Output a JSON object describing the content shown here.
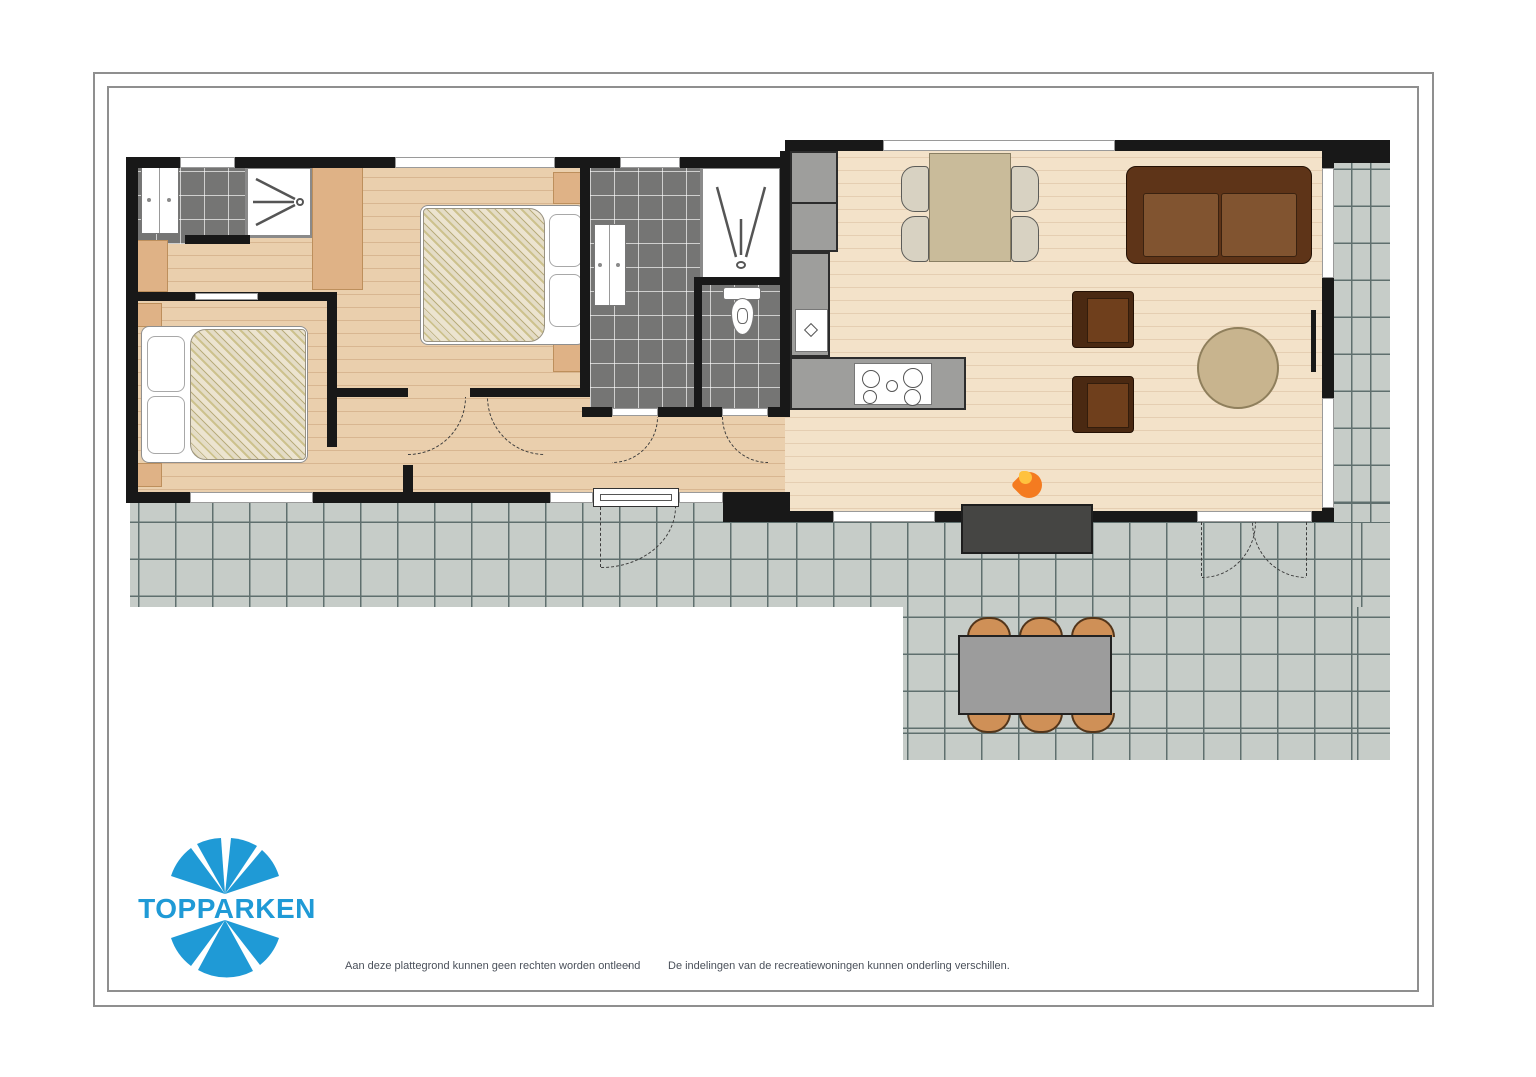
{
  "document": {
    "type": "floor-plan",
    "brand": "TOPPARKEN"
  },
  "logo": {
    "text": "TOPPARKEN",
    "color": "#1f9ad6"
  },
  "footer": {
    "left": "Aan deze plattegrond kunnen geen rechten worden ontleend",
    "separator": "-",
    "right": "De indelingen van de recreatiewoningen kunnen onderling verschillen."
  },
  "icons": {
    "flame": "🔥",
    "shower_spray": "spray-lines",
    "sink_diamond": "◇"
  },
  "rooms": [
    {
      "name": "bedroom-1"
    },
    {
      "name": "bedroom-2"
    },
    {
      "name": "small-bathroom"
    },
    {
      "name": "bathroom"
    },
    {
      "name": "toilet"
    },
    {
      "name": "hallway"
    },
    {
      "name": "living-room-kitchen"
    },
    {
      "name": "terrace"
    }
  ],
  "furniture": [
    "double-bed-1",
    "double-bed-2",
    "wardrobe",
    "vanity-cabinet",
    "shower",
    "toilet-bowl",
    "kitchen-counter",
    "sink",
    "hob",
    "dining-table",
    "dining-chairs",
    "sofa",
    "armchair",
    "armchair",
    "coffee-table",
    "fireplace",
    "outdoor-dining-table",
    "outdoor-chairs"
  ],
  "colors": {
    "wall": "#181818",
    "wood_floor": "#eacfad",
    "living_floor": "#f3e2c9",
    "bath_tile": "#757574",
    "terrace_tile": "#c6ccc8",
    "counter": "#9e9e9c",
    "closet": "#dfb286",
    "sofa": "#5e3418",
    "dining_table": "#c9bb9a",
    "outdoor_chair": "#cf9057",
    "logo_blue": "#1f9ad6"
  }
}
